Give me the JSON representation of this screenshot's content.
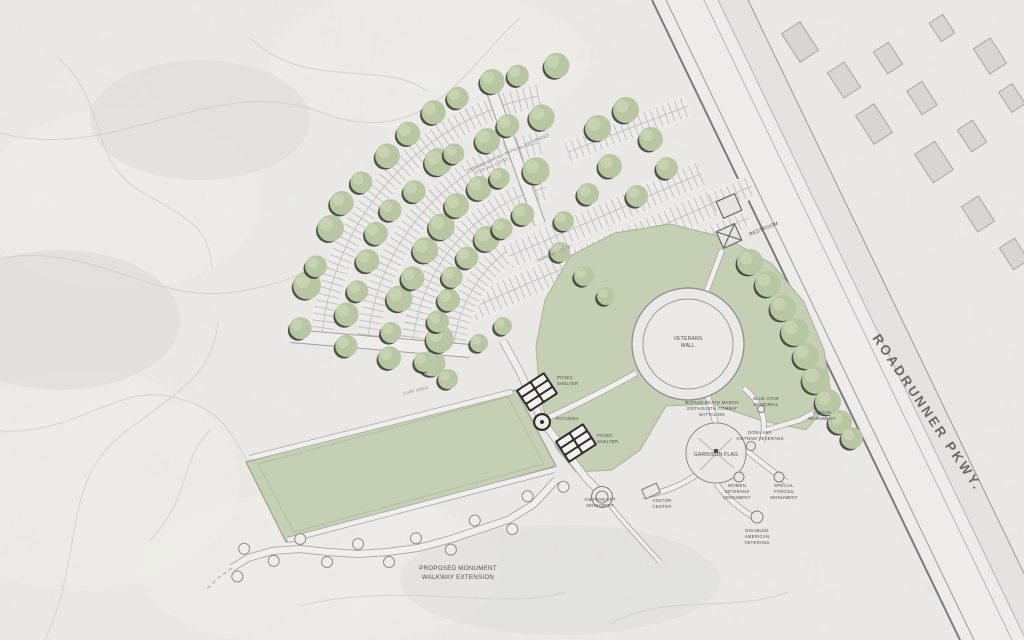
{
  "road": {
    "name": "ROADRUNNER PKWY."
  },
  "parking": {
    "lot_a_line1": "PARKING LOT 'A' - TYPICAL 100 SPACES",
    "lot_a_line2": "(TYP. ALL LOTS)",
    "lot_b": "PARKING LOT 'B'"
  },
  "buildings": {
    "restroom": "RESTROOM",
    "picnic_shelter": [
      "PICNIC",
      "SHELTER"
    ],
    "rotunda": "ROTUNDA"
  },
  "features": {
    "veterans_wall": [
      "VETERANS",
      "WALL"
    ],
    "garrison_flag": "GARRISON FLAG",
    "turf": "TURF AREA",
    "walkway": [
      "PROPOSED MONUMENT",
      "WALKWAY EXTENSION"
    ]
  },
  "monuments": {
    "bataan_death_march": [
      "BATAAN DEATH MARCH",
      "200TH/515TH COMBAT",
      "BATTALION"
    ],
    "blue_star": [
      "BLUE STAR",
      "MEMORIAL"
    ],
    "bataan": [
      "BATAAN",
      "MONUMENT"
    ],
    "dona_ana": [
      "DOÑA ANA",
      "VIETNAM VETERANS"
    ],
    "women": [
      "WOMEN",
      "VETERANS",
      "MONUMENT"
    ],
    "special_forces": [
      "SPECIAL",
      "FORCES",
      "MONUMENT"
    ],
    "disabled": [
      "DISABLED",
      "AMERICAN",
      "VETERANS"
    ],
    "vietnam": [
      "VIETNAM VET",
      "MONUMENT"
    ],
    "visitor_center": [
      "VISITOR",
      "CENTER"
    ]
  },
  "colors": {
    "canvas": "#e8e7e4",
    "road_surface": "#edecea",
    "turf": "#c5cfb4",
    "tree": "#b9c6a2",
    "tree_shadow": "#31382d",
    "ink": "#4c4c4a"
  }
}
